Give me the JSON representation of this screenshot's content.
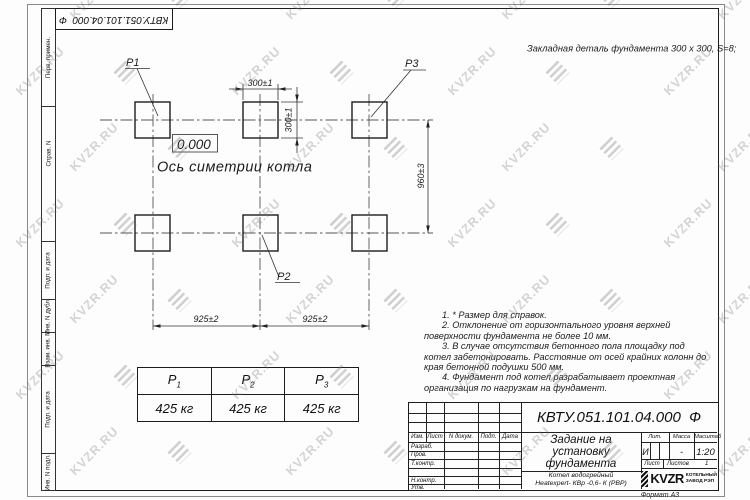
{
  "watermark": {
    "text": "KVZR.RU"
  },
  "corner_stamp": {
    "designation": "КВТУ.051.101.04.000  Ф"
  },
  "side_column": {
    "labels": [
      "Перв. примен.",
      "Справ. N",
      "Подп. и дата",
      "Инв. N дубл.",
      "Взам. инв. N",
      "Подп. и дата",
      "Инв. N подл."
    ]
  },
  "drawing": {
    "top_note": "Закладная деталь фундамента  300 х 300,  S=8;",
    "labels": {
      "p1": "P1",
      "p2": "P2",
      "p3": "P3"
    },
    "dimensions": {
      "width_top": "300±1",
      "height_right": "300±1",
      "vertical_span": "960±3",
      "bottom_left": "925±2",
      "bottom_right": "925±2"
    },
    "elevation_mark": "0.000",
    "axis_caption": "Ось симетрии котла"
  },
  "notes": {
    "items": [
      "1. * Размер для справок.",
      "2. Отклонение от горизонтального уровня верхней поверхности фундамента не более 10 мм.",
      "3. В случае отсутствия бетонного пола площадку под котел забетонировать. Расстояние от осей крайних колонн до края бетонной подушки 500 мм.",
      "4. Фундамент под котел разрабатывает проектная организация по нагрузкам на фундамент."
    ]
  },
  "load_table": {
    "columns": [
      {
        "base": "P",
        "sub": "1",
        "value": "425 кг"
      },
      {
        "base": "P",
        "sub": "2",
        "value": "425 кг"
      },
      {
        "base": "P",
        "sub": "3",
        "value": "425 кг"
      }
    ]
  },
  "title_block": {
    "designation": "КВТУ.051.101.04.000  Ф",
    "doc_title_lines": [
      "Задание на",
      "установку",
      "фундамента"
    ],
    "product_lines": [
      "Котел водогрейный",
      "Heatexpert- КВр -0,6- К (РВР)"
    ],
    "header_cells": [
      "Изм.",
      "Лист",
      "N докум.",
      "Подп.",
      "Дата"
    ],
    "signature_rows": [
      "Разраб.",
      "Пров.",
      "Т.контр.",
      "",
      "Н.контр.",
      "Утв."
    ],
    "litera": {
      "label": "Лит.",
      "value": "И"
    },
    "mass": {
      "label": "Масса",
      "value": "-"
    },
    "scale": {
      "label": "Масштаб",
      "value": "1:20"
    },
    "sheet": {
      "label": "Лист",
      "value": ""
    },
    "sheets": {
      "label": "Листов",
      "value": "1"
    },
    "company": {
      "name": "KVZR",
      "line1": "КОТЕЛЬНЫЙ",
      "line2": "ЗАВОД РЭП"
    },
    "format_note": "Формат А3"
  }
}
